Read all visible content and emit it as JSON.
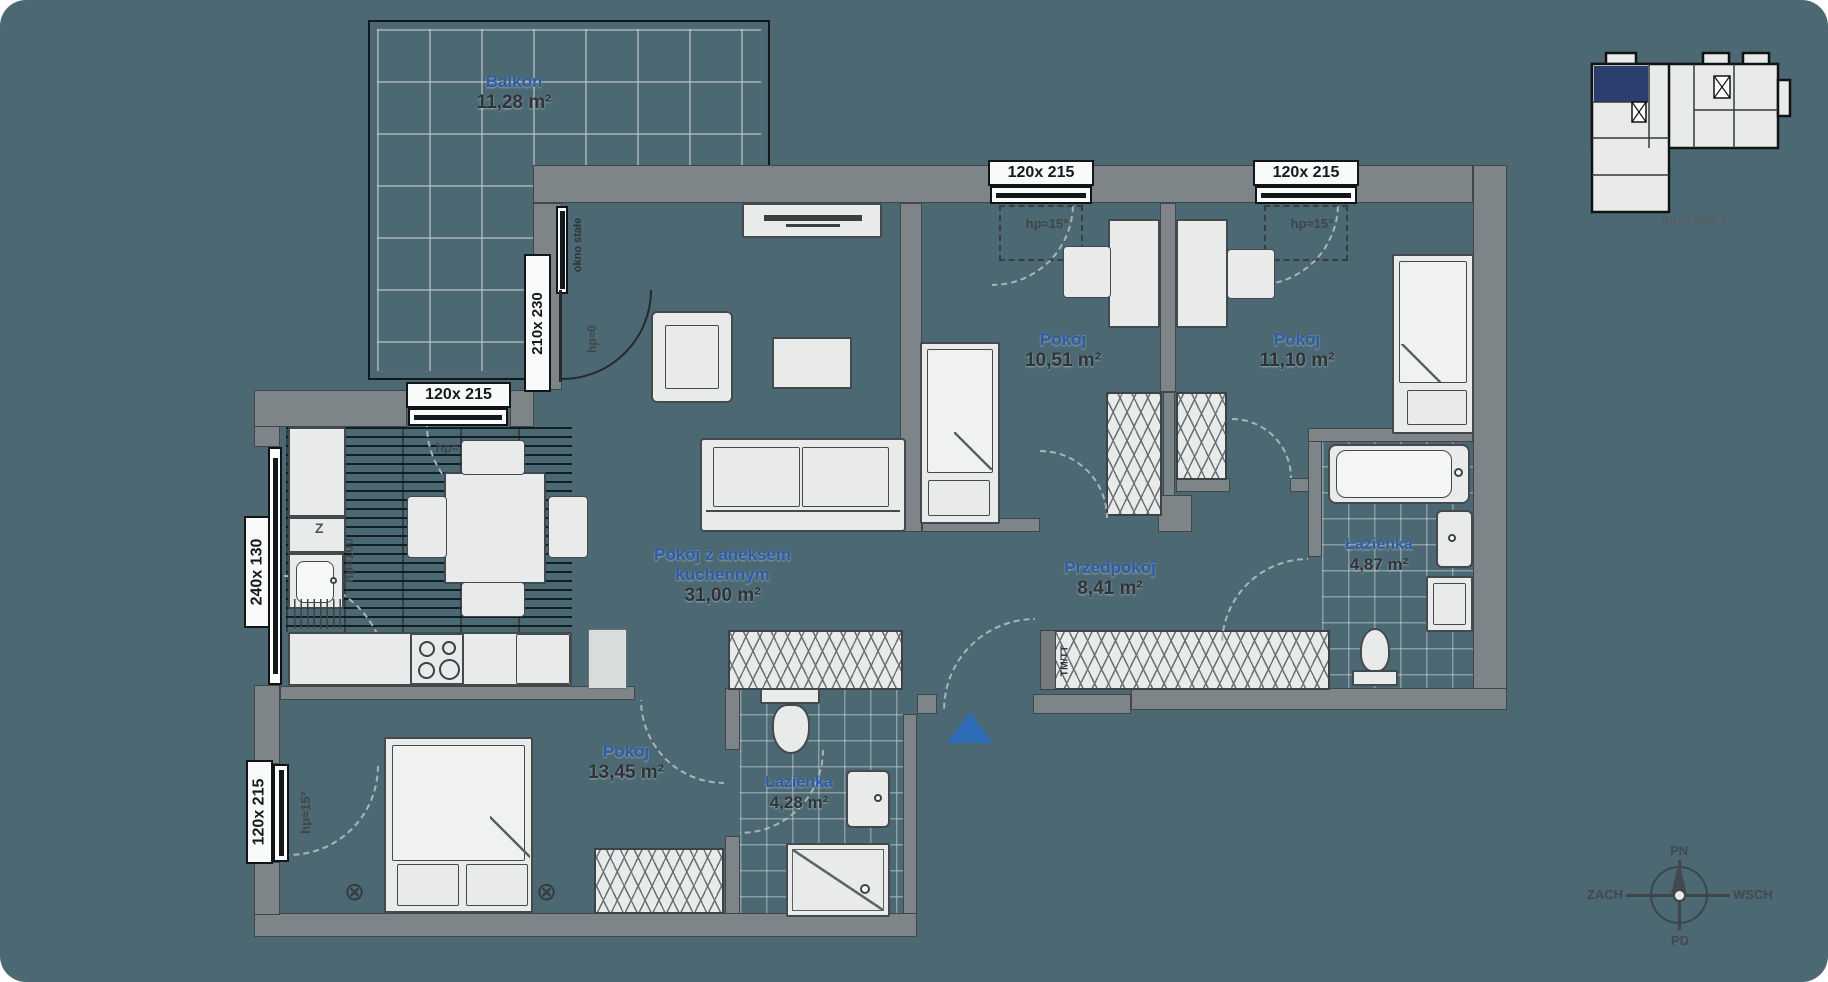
{
  "plan": {
    "rooms": {
      "balcony": {
        "name": "Balkon",
        "area": "11,28 m²"
      },
      "living": {
        "name_line1": "Pokój z aneksem",
        "name_line2": "kuchennym",
        "area": "31,00 m²"
      },
      "bedroom_a": {
        "name": "Pokój",
        "area": "10,51 m²"
      },
      "bedroom_b": {
        "name": "Pokój",
        "area": "11,10 m²"
      },
      "hallway": {
        "name": "Przedpokój",
        "area": "8,41 m²"
      },
      "bathroom_a": {
        "name": "Łazienka",
        "area": "4,87 m²"
      },
      "bedroom_c": {
        "name": "Pokój",
        "area": "13,45 m²"
      },
      "bathroom_b": {
        "name": "Łazienka",
        "area": "4,28 m²"
      }
    },
    "windows": {
      "bedroom_a_top": "120x 215",
      "bedroom_b_top": "120x 215",
      "kitchen_top": "120x 215",
      "bedroom_c_left": "120x 215",
      "balcony_door": "210x 230",
      "kitchen_left": "240x 130",
      "sill_note_15": "hp≈15°",
      "sill_note_100": "hp≈100",
      "sill_note_0": "hp≈0",
      "fixed_note": "okno stałe"
    },
    "labels": {
      "wardrobe": "TM/TT",
      "dishwasher": "Z"
    },
    "symbols": {
      "radiator": "⊗"
    },
    "minimap": {
      "caption": "BUDYNEK E"
    },
    "compass": {
      "n": "PN",
      "e": "WSCH",
      "s": "PD",
      "w": "ZACH"
    },
    "colors": {
      "background": "#4C6872",
      "wall": "#7E8588",
      "fixture": "#E9EBEB",
      "room_name": "#2B5CA8",
      "area_text": "#2E3338",
      "highlight_unit": "#2C3E6D",
      "entrance_marker": "#2E6CB8"
    }
  }
}
